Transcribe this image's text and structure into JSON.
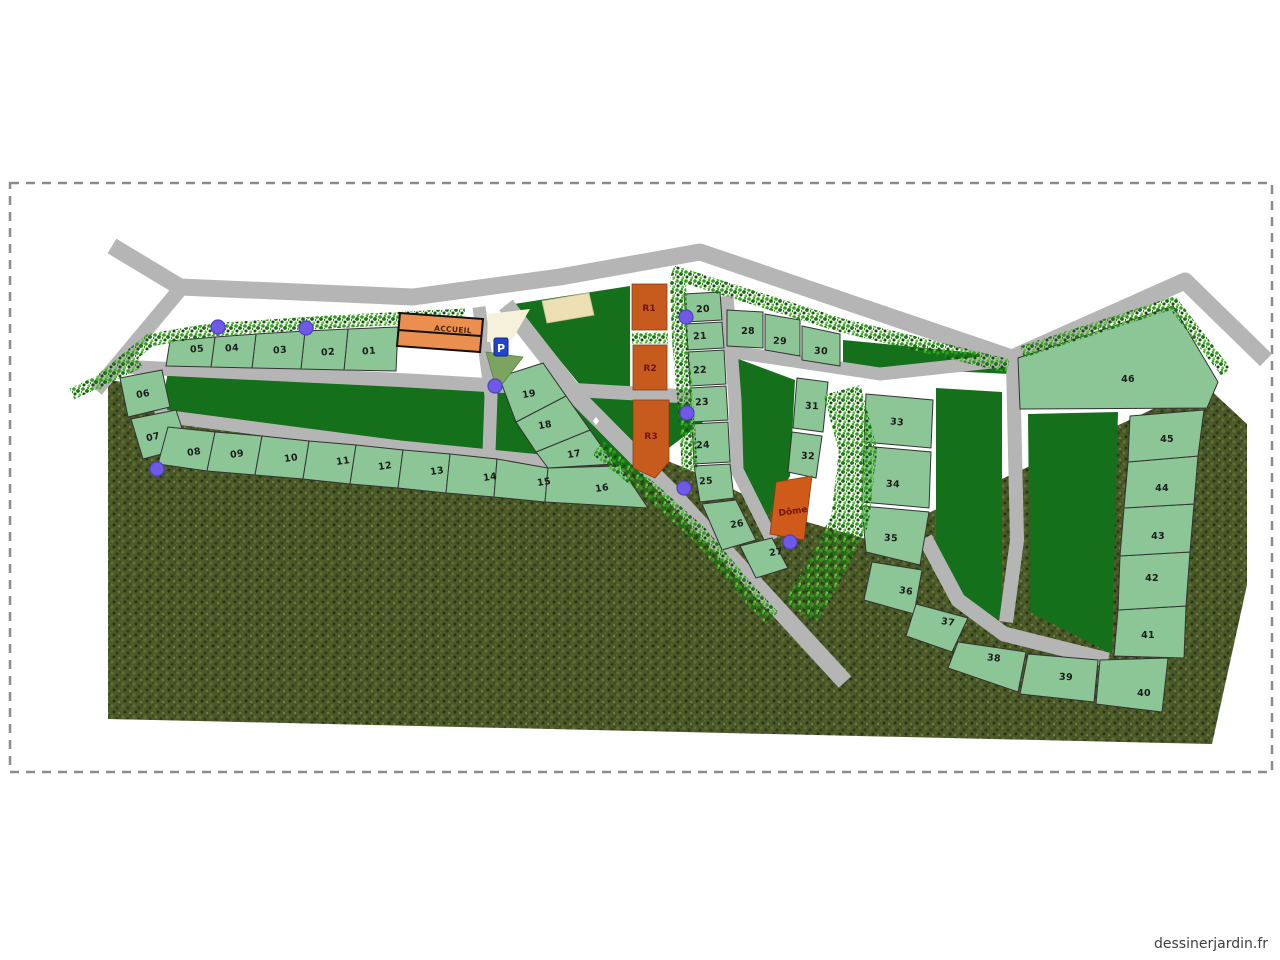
{
  "map": {
    "plots": [
      "01",
      "02",
      "03",
      "04",
      "05",
      "06",
      "07",
      "08",
      "09",
      "10",
      "11",
      "12",
      "13",
      "14",
      "15",
      "16",
      "17",
      "18",
      "19",
      "20",
      "21",
      "22",
      "23",
      "24",
      "25",
      "26",
      "27",
      "28",
      "29",
      "30",
      "31",
      "32",
      "33",
      "34",
      "35",
      "36",
      "37",
      "38",
      "39",
      "40",
      "41",
      "42",
      "43",
      "44",
      "45",
      "46"
    ],
    "buildings": {
      "accueil": "ACCUEIL",
      "r1": "R1",
      "r2": "R2",
      "r3": "R3",
      "dome": "Dôme"
    },
    "parking_label": "P",
    "watermark": "dessinerjardin.fr",
    "colors": {
      "plot_fill": "#8cc696",
      "lawn_dark": "#14701a",
      "road_gray": "#b5b5b5",
      "accueil_orange": "#ea8f4f",
      "unit_orange": "#c75b1e",
      "marker_purple": "#6f5ae8",
      "parking_blue": "#1f46c8",
      "ground_texture": "#4b592a"
    }
  }
}
